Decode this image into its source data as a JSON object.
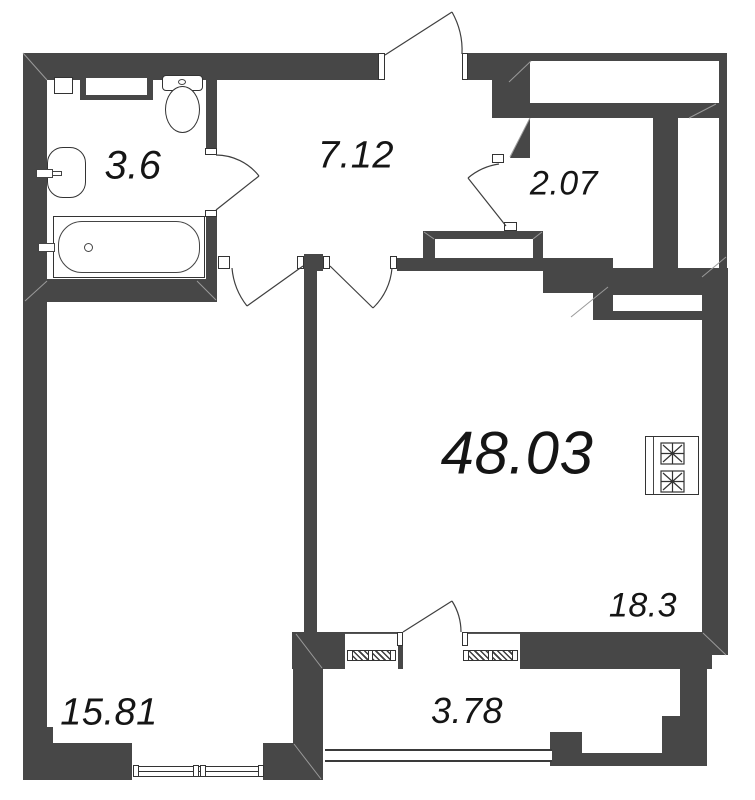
{
  "plan": {
    "type": "apartment-floor-plan",
    "total_area_label": "48.03",
    "rooms": [
      {
        "name": "bathroom",
        "area_label": "3.6"
      },
      {
        "name": "hallway",
        "area_label": "7.12"
      },
      {
        "name": "wardrobe",
        "area_label": "2.07"
      },
      {
        "name": "kitchen-living-room",
        "area_label": "18.3"
      },
      {
        "name": "bedroom",
        "area_label": "15.81"
      },
      {
        "name": "balcony",
        "area_label": "3.78"
      }
    ],
    "fixtures": [
      "bathtub",
      "sink",
      "toilet",
      "washing-machine",
      "wall-niche",
      "stove",
      "radiator",
      "window",
      "balcony-glazing",
      "door-swing"
    ],
    "colors": {
      "wall": "#474747",
      "outline": "#3a3a3a",
      "seam": "#9a9a9a",
      "label": "#151515",
      "background": "#ffffff"
    }
  }
}
